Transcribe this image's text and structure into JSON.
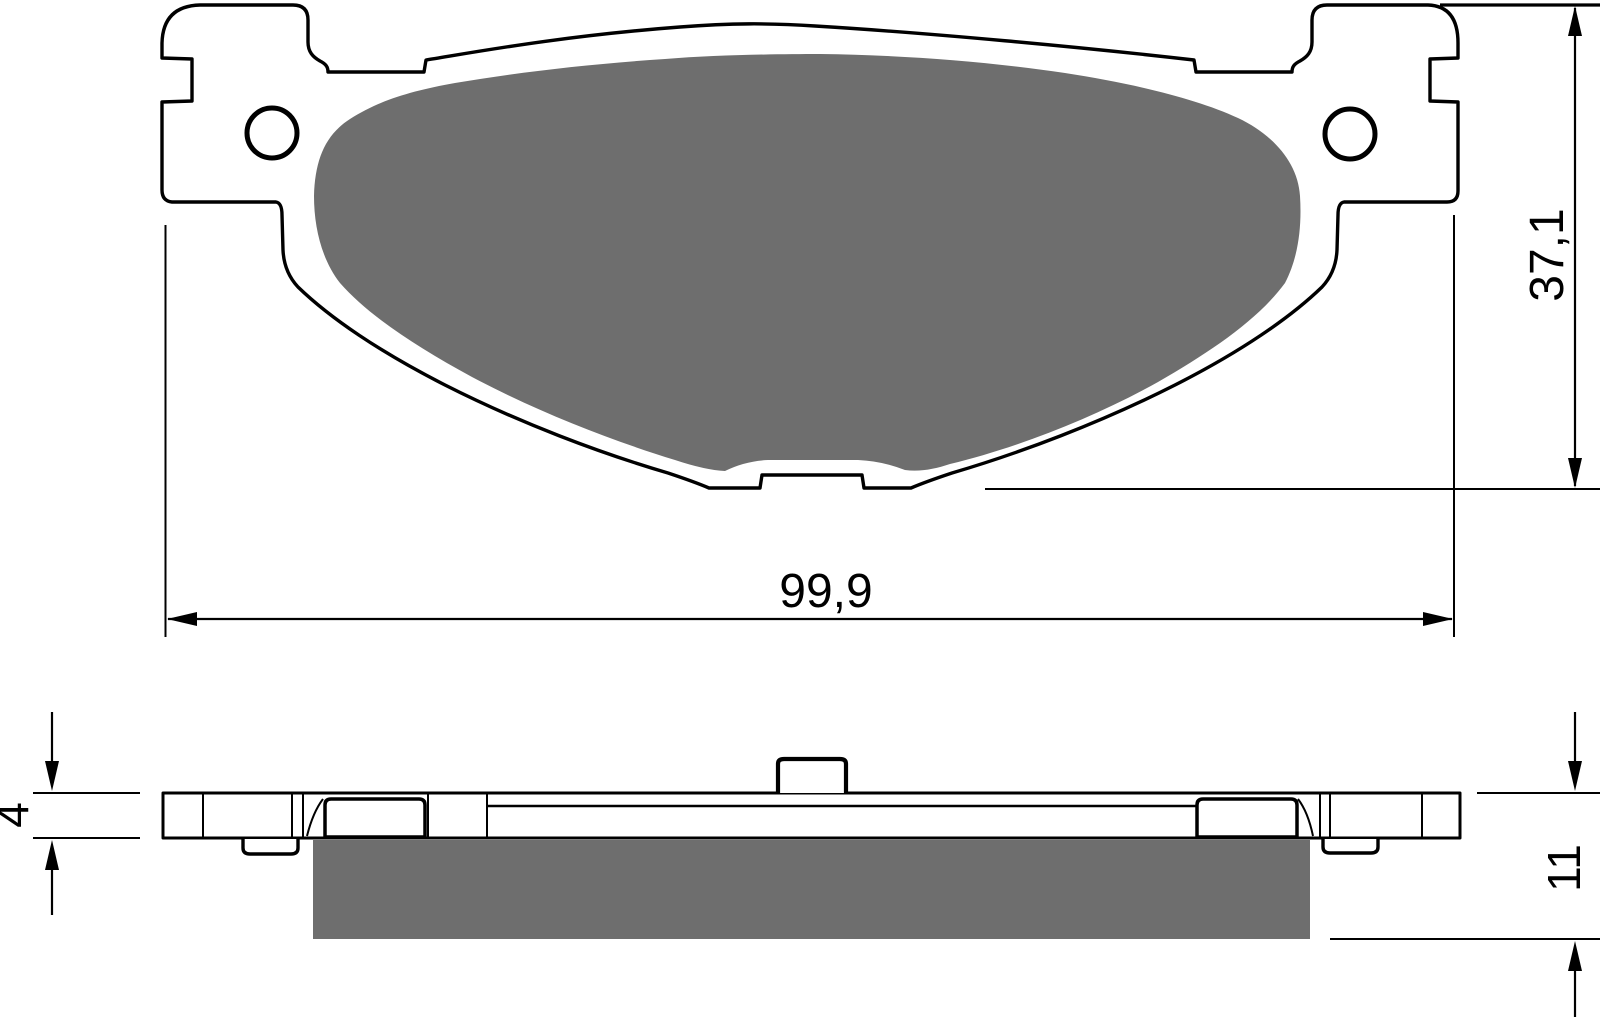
{
  "colors": {
    "line": "#000000",
    "friction": "#6e6e6e",
    "background": "#ffffff"
  },
  "views": {
    "top": {
      "dimensions": {
        "width_label": "99,9",
        "height_label": "37,1"
      }
    },
    "side": {
      "dimensions": {
        "backplate_thickness_label": "4",
        "total_thickness_label": "11"
      }
    }
  }
}
